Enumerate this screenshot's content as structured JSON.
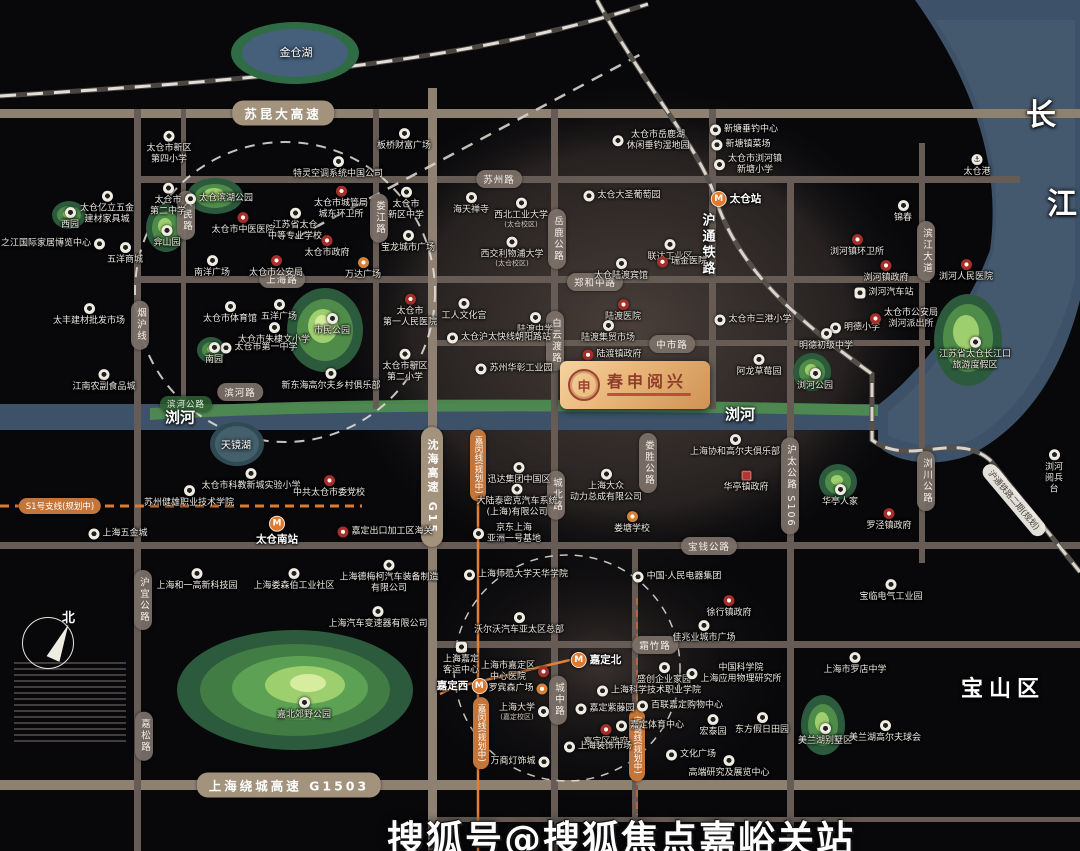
{
  "map": {
    "logo": {
      "title": "春申阅兴"
    },
    "watermark": "搜狐号@搜狐焦点嘉峪关站",
    "compass_label": "北",
    "colors": {
      "background": "#08080b",
      "water": "#3d5269",
      "park_green": "#4f8c4a",
      "road": "#665c55",
      "highway": "#a3927c",
      "metro_orange": "#dd7a30",
      "poi_red": "#a63029",
      "logo_gold": "#e8b477"
    },
    "area_labels": [
      {
        "t": "金仓湖",
        "x": 296,
        "y": 52,
        "f": 11,
        "b": 0,
        "v": 0
      },
      {
        "t": "天镜湖",
        "x": 236,
        "y": 444,
        "f": 10,
        "b": 0,
        "v": 0
      },
      {
        "t": "浏河",
        "x": 180,
        "y": 417,
        "f": 15,
        "b": 1,
        "v": 0
      },
      {
        "t": "浏河",
        "x": 740,
        "y": 414,
        "f": 15,
        "b": 1,
        "v": 0
      },
      {
        "t": "长",
        "x": 1041,
        "y": 112,
        "f": 30,
        "b": 1,
        "v": 0
      },
      {
        "t": "江",
        "x": 1062,
        "y": 201,
        "f": 30,
        "b": 1,
        "v": 0
      },
      {
        "t": "宝山区",
        "x": 1003,
        "y": 687,
        "f": 22,
        "b": 1,
        "v": 0
      },
      {
        "t": "沪通铁路",
        "x": 707,
        "y": 245,
        "f": 13,
        "b": 1,
        "v": 1
      }
    ],
    "road_labels": [
      {
        "t": "苏昆大高速",
        "x": 283,
        "y": 113,
        "o": "h",
        "s": "hw"
      },
      {
        "t": "上海绕城高速 G1503",
        "x": 289,
        "y": 785,
        "o": "h",
        "s": "hw"
      },
      {
        "t": "沈海高速 G15",
        "x": 432,
        "y": 487,
        "o": "v",
        "s": "hw"
      },
      {
        "t": "苏州路",
        "x": 499,
        "y": 179,
        "o": "h",
        "s": "st"
      },
      {
        "t": "上海路",
        "x": 282,
        "y": 279,
        "o": "h",
        "s": "st"
      },
      {
        "t": "郑和中路",
        "x": 595,
        "y": 282,
        "o": "h",
        "s": "st"
      },
      {
        "t": "中市路",
        "x": 672,
        "y": 344,
        "o": "h",
        "s": "st"
      },
      {
        "t": "宝钱公路",
        "x": 709,
        "y": 546,
        "o": "h",
        "s": "st"
      },
      {
        "t": "霜竹路",
        "x": 655,
        "y": 645,
        "o": "h",
        "s": "st"
      },
      {
        "t": "滨河路",
        "x": 240,
        "y": 392,
        "o": "h",
        "s": "st"
      },
      {
        "t": "滨河公路",
        "x": 186,
        "y": 404,
        "o": "h",
        "s": "grn"
      },
      {
        "t": "烟沪线",
        "x": 140,
        "y": 325,
        "o": "v",
        "s": "st"
      },
      {
        "t": "人民路",
        "x": 186,
        "y": 215,
        "o": "v",
        "s": "st"
      },
      {
        "t": "娄江路",
        "x": 379,
        "y": 218,
        "o": "v",
        "s": "st"
      },
      {
        "t": "岳鹿公路",
        "x": 557,
        "y": 239,
        "o": "v",
        "s": "st"
      },
      {
        "t": "白云渡路",
        "x": 555,
        "y": 341,
        "o": "v",
        "s": "st"
      },
      {
        "t": "城北路",
        "x": 556,
        "y": 495,
        "o": "v",
        "s": "st"
      },
      {
        "t": "城中路",
        "x": 558,
        "y": 700,
        "o": "v",
        "s": "st"
      },
      {
        "t": "娄胜公路",
        "x": 648,
        "y": 463,
        "o": "v",
        "s": "st"
      },
      {
        "t": "沪太公路 S106",
        "x": 790,
        "y": 486,
        "o": "v",
        "s": "st"
      },
      {
        "t": "滨江大道",
        "x": 926,
        "y": 251,
        "o": "v",
        "s": "st"
      },
      {
        "t": "浏川公路",
        "x": 926,
        "y": 481,
        "o": "v",
        "s": "st"
      },
      {
        "t": "沪宜公路",
        "x": 143,
        "y": 600,
        "o": "v",
        "s": "st"
      },
      {
        "t": "嘉松路",
        "x": 144,
        "y": 736,
        "o": "v",
        "s": "st"
      },
      {
        "t": "S1号支线(规划中)",
        "x": 60,
        "y": 506,
        "o": "h",
        "s": "or"
      },
      {
        "t": "嘉闵线(规划中)",
        "x": 478,
        "y": 465,
        "o": "v",
        "s": "or"
      },
      {
        "t": "嘉闵线(规划中)",
        "x": 481,
        "y": 733,
        "o": "v",
        "s": "or"
      },
      {
        "t": "宝嘉线(规划中)",
        "x": 637,
        "y": 745,
        "o": "v",
        "s": "or"
      },
      {
        "t": "沪通铁路二期(规划)",
        "x": 1014,
        "y": 500,
        "o": "d",
        "s": "rail"
      }
    ],
    "pois": [
      {
        "t": "太仓市新区\n第四小学",
        "x": 169,
        "y": 148,
        "i": "w"
      },
      {
        "t": "特灵空调系统中国公司",
        "x": 338,
        "y": 168,
        "i": "w"
      },
      {
        "t": "板桥财富广场",
        "x": 404,
        "y": 140,
        "i": "w"
      },
      {
        "t": "太仓市岳鹿湖\n休闲垂钓湿地园",
        "x": 651,
        "y": 141,
        "i": "w",
        "p": "l"
      },
      {
        "t": "新塘垂钓中心",
        "x": 744,
        "y": 130,
        "i": "w",
        "p": "l"
      },
      {
        "t": "新塘镇菜场",
        "x": 741,
        "y": 145,
        "i": "w",
        "p": "l"
      },
      {
        "t": "太仓市浏河镇\n新塘小学",
        "x": 748,
        "y": 165,
        "i": "w",
        "p": "l"
      },
      {
        "t": "太仓港",
        "x": 977,
        "y": 166,
        "i": "a"
      },
      {
        "t": "锦春",
        "x": 903,
        "y": 212,
        "i": "w"
      },
      {
        "t": "太仓亿立五金\n建材家具城",
        "x": 107,
        "y": 208,
        "i": "w"
      },
      {
        "t": "西园",
        "x": 70,
        "y": 219,
        "i": "w"
      },
      {
        "t": "之江国际家居博览中心",
        "x": 53,
        "y": 244,
        "i": "w",
        "p": "r"
      },
      {
        "t": "五洋商城",
        "x": 125,
        "y": 254,
        "i": "w"
      },
      {
        "t": "太仓市\n第二中学",
        "x": 168,
        "y": 200,
        "i": "w"
      },
      {
        "t": "太仓滨湖公园",
        "x": 219,
        "y": 199,
        "i": "w",
        "p": "l"
      },
      {
        "t": "弇山园",
        "x": 167,
        "y": 237,
        "i": "w"
      },
      {
        "t": "太仓市中医医院",
        "x": 243,
        "y": 224,
        "i": "r"
      },
      {
        "t": "江苏省太仓\n中等专业学校",
        "x": 295,
        "y": 225,
        "i": "w"
      },
      {
        "t": "太仓市城管局\n城东环卫所",
        "x": 341,
        "y": 203,
        "i": "r"
      },
      {
        "t": "太仓市\n新区中学",
        "x": 406,
        "y": 204,
        "i": "w"
      },
      {
        "t": "宝龙城市广场",
        "x": 408,
        "y": 242,
        "i": "w"
      },
      {
        "t": "海天禅寺",
        "x": 471,
        "y": 204,
        "i": "w"
      },
      {
        "t": "西北工业大学",
        "s": "(太仓校区)",
        "x": 521,
        "y": 213,
        "i": "w"
      },
      {
        "t": "西交利物浦大学",
        "s": "(太仓校区)",
        "x": 512,
        "y": 252,
        "i": "w"
      },
      {
        "t": "太仓大圣葡萄园",
        "x": 622,
        "y": 196,
        "i": "w",
        "p": "l"
      },
      {
        "t": "联达工业区",
        "x": 670,
        "y": 251,
        "i": "w"
      },
      {
        "t": "瑞金医院",
        "x": 682,
        "y": 262,
        "i": "r",
        "p": "l"
      },
      {
        "t": "太仓陆渡宾馆",
        "x": 621,
        "y": 270,
        "i": "w"
      },
      {
        "t": "南洋广场",
        "x": 212,
        "y": 267,
        "i": "w"
      },
      {
        "t": "太仓市公安局",
        "x": 276,
        "y": 267,
        "i": "r"
      },
      {
        "t": "太仓市政府",
        "x": 327,
        "y": 247,
        "i": "r"
      },
      {
        "t": "万达广场",
        "x": 363,
        "y": 269,
        "i": "o"
      },
      {
        "t": "太仓市体育馆",
        "x": 230,
        "y": 313,
        "i": "w"
      },
      {
        "t": "五洋广场",
        "x": 279,
        "y": 311,
        "i": "w"
      },
      {
        "t": "太仓市朱棣文小学",
        "x": 274,
        "y": 334,
        "i": "w"
      },
      {
        "t": "市民公园",
        "x": 332,
        "y": 325,
        "i": "w"
      },
      {
        "t": "太仓市第一中学",
        "x": 259,
        "y": 348,
        "i": "w",
        "p": "l"
      },
      {
        "t": "南园",
        "x": 214,
        "y": 354,
        "i": "w"
      },
      {
        "t": "新东海高尔夫乡村俱乐部",
        "x": 331,
        "y": 380,
        "i": "w"
      },
      {
        "t": "太仓市\n第一人民医院",
        "x": 410,
        "y": 311,
        "i": "r"
      },
      {
        "t": "太仓市新区\n第二小学",
        "x": 405,
        "y": 366,
        "i": "w"
      },
      {
        "t": "太丰建材批发市场",
        "x": 89,
        "y": 315,
        "i": "w"
      },
      {
        "t": "江南农副食品城",
        "x": 104,
        "y": 381,
        "i": "w"
      },
      {
        "t": "工人文化宫",
        "x": 464,
        "y": 310,
        "i": "w"
      },
      {
        "t": "陆渡中学",
        "x": 535,
        "y": 324,
        "i": "w"
      },
      {
        "t": "太仓沪太快线朝阳路站",
        "x": 499,
        "y": 338,
        "i": "w",
        "p": "l"
      },
      {
        "t": "苏州华彰工业园",
        "x": 514,
        "y": 369,
        "i": "w",
        "p": "l"
      },
      {
        "t": "陆渡医院",
        "x": 623,
        "y": 311,
        "i": "r"
      },
      {
        "t": "陆渡集贸市场",
        "x": 608,
        "y": 332,
        "i": "w"
      },
      {
        "t": "陆渡镇政府",
        "x": 612,
        "y": 355,
        "i": "r",
        "p": "l"
      },
      {
        "t": "太仓市三港小学",
        "x": 753,
        "y": 320,
        "i": "w",
        "p": "l"
      },
      {
        "t": "阿龙草莓园",
        "x": 759,
        "y": 366,
        "i": "w"
      },
      {
        "t": "明德小学",
        "x": 855,
        "y": 328,
        "i": "w",
        "p": "l"
      },
      {
        "t": "明德初级中学",
        "x": 826,
        "y": 340,
        "i": "w"
      },
      {
        "t": "浏河汽车站",
        "x": 884,
        "y": 293,
        "i": "b",
        "p": "l"
      },
      {
        "t": "太仓市公安局\n浏河派出所",
        "x": 904,
        "y": 319,
        "i": "r",
        "p": "l"
      },
      {
        "t": "浏河镇环卫所",
        "x": 857,
        "y": 246,
        "i": "r"
      },
      {
        "t": "浏河镇政府",
        "x": 886,
        "y": 272,
        "i": "r"
      },
      {
        "t": "浏河人民医院",
        "x": 966,
        "y": 271,
        "i": "r"
      },
      {
        "t": "浏河公园",
        "x": 815,
        "y": 380,
        "i": "w"
      },
      {
        "t": "江苏省太仓长江口\n旅游度假区",
        "x": 975,
        "y": 354,
        "i": "w"
      },
      {
        "t": "太仓市科教新城实验小学",
        "x": 251,
        "y": 480,
        "i": "w"
      },
      {
        "t": "苏州健雄职业技术学院",
        "x": 189,
        "y": 497,
        "i": "w"
      },
      {
        "t": "中共太仓市委党校",
        "x": 329,
        "y": 487,
        "i": "r"
      },
      {
        "t": "上海协和高尔夫俱乐部",
        "x": 735,
        "y": 446,
        "i": "w"
      },
      {
        "t": "华亭镇政府",
        "x": 746,
        "y": 482,
        "i": "q"
      },
      {
        "t": "华亭人家",
        "x": 840,
        "y": 496,
        "i": "w"
      },
      {
        "t": "罗泾镇政府",
        "x": 889,
        "y": 520,
        "i": "r"
      },
      {
        "t": "上海五金城",
        "x": 118,
        "y": 534,
        "i": "w",
        "p": "l"
      },
      {
        "t": "嘉定出口加工区海关",
        "x": 385,
        "y": 532,
        "i": "r",
        "p": "l"
      },
      {
        "t": "迅达集团中国区",
        "x": 519,
        "y": 474,
        "i": "w"
      },
      {
        "t": "大陆泰密克汽车系统\n(上海)有限公司",
        "x": 517,
        "y": 501,
        "i": "w"
      },
      {
        "t": "京东上海\n亚洲一号基地",
        "x": 507,
        "y": 534,
        "i": "w",
        "p": "l"
      },
      {
        "t": "上海大众\n动力总成有限公司",
        "x": 606,
        "y": 486,
        "i": "w"
      },
      {
        "t": "娄塘学校",
        "x": 632,
        "y": 523,
        "i": "o"
      },
      {
        "t": "上海和一高新科技园",
        "x": 197,
        "y": 580,
        "i": "w"
      },
      {
        "t": "上海娄森伯工业社区",
        "x": 294,
        "y": 580,
        "i": "w"
      },
      {
        "t": "上海德梅柯汽车装备制造\n有限公司",
        "x": 389,
        "y": 577,
        "i": "w"
      },
      {
        "t": "上海汽车变速器有限公司",
        "x": 378,
        "y": 618,
        "i": "w"
      },
      {
        "t": "嘉北郊野公园",
        "x": 304,
        "y": 709,
        "i": "w"
      },
      {
        "t": "上海师范大学天华学院",
        "x": 516,
        "y": 575,
        "i": "w",
        "p": "l"
      },
      {
        "t": "中国·人民电器集团",
        "x": 677,
        "y": 577,
        "i": "w",
        "p": "l"
      },
      {
        "t": "徐行镇政府",
        "x": 729,
        "y": 607,
        "i": "r"
      },
      {
        "t": "佳兆业城市广场",
        "x": 704,
        "y": 632,
        "i": "w"
      },
      {
        "t": "沃尔沃汽车亚太区总部",
        "x": 519,
        "y": 624,
        "i": "w"
      },
      {
        "t": "上海嘉定\n客运中心",
        "x": 461,
        "y": 659,
        "i": "b"
      },
      {
        "t": "上海市嘉定区\n中心医院",
        "x": 515,
        "y": 672,
        "i": "r",
        "p": "r"
      },
      {
        "t": "罗宾森广场",
        "x": 518,
        "y": 689,
        "i": "o",
        "p": "r"
      },
      {
        "t": "上海大学",
        "s": "(嘉定校区)",
        "x": 524,
        "y": 712,
        "i": "w",
        "p": "r"
      },
      {
        "t": "嘉定紫藤园",
        "x": 605,
        "y": 709,
        "i": "w",
        "p": "l"
      },
      {
        "t": "上海科学技术职业学院",
        "x": 649,
        "y": 691,
        "i": "w",
        "p": "l"
      },
      {
        "t": "百联嘉定购物中心",
        "x": 680,
        "y": 706,
        "i": "w",
        "p": "l"
      },
      {
        "t": "盛创企业家园",
        "x": 664,
        "y": 674,
        "i": "w"
      },
      {
        "t": "中国科学院\n上海应用物理研究所",
        "x": 734,
        "y": 674,
        "i": "w",
        "p": "l"
      },
      {
        "t": "嘉定区政府",
        "x": 606,
        "y": 736,
        "i": "r"
      },
      {
        "t": "嘉定体育中心",
        "x": 650,
        "y": 726,
        "i": "w",
        "p": "l"
      },
      {
        "t": "宏泰园",
        "x": 713,
        "y": 726,
        "i": "w"
      },
      {
        "t": "东方假日田园",
        "x": 762,
        "y": 724,
        "i": "w"
      },
      {
        "t": "上海装饰市场",
        "x": 598,
        "y": 747,
        "i": "w",
        "p": "l"
      },
      {
        "t": "万商灯饰城",
        "x": 520,
        "y": 762,
        "i": "w",
        "p": "r"
      },
      {
        "t": "文化广场",
        "x": 691,
        "y": 755,
        "i": "w",
        "p": "l"
      },
      {
        "t": "高端研究及展览中心",
        "x": 729,
        "y": 767,
        "i": "w"
      },
      {
        "t": "宝临电气工业园",
        "x": 891,
        "y": 591,
        "i": "w"
      },
      {
        "t": "上海市罗店中学",
        "x": 855,
        "y": 664,
        "i": "w"
      },
      {
        "t": "美兰湖别墅区",
        "x": 825,
        "y": 735,
        "i": "w"
      },
      {
        "t": "美兰湖高尔夫球会",
        "x": 885,
        "y": 732,
        "i": "w"
      },
      {
        "t": "浏河阅兵台",
        "x": 1054,
        "y": 472,
        "i": "w"
      },
      {
        "t": "太仓站",
        "x": 736,
        "y": 199,
        "i": "m",
        "p": "l"
      },
      {
        "t": "太仓南站",
        "x": 277,
        "y": 531,
        "i": "m"
      },
      {
        "t": "嘉定北",
        "x": 596,
        "y": 660,
        "i": "m",
        "p": "l"
      },
      {
        "t": "嘉定西",
        "x": 462,
        "y": 686,
        "i": "m",
        "p": "r"
      }
    ]
  }
}
